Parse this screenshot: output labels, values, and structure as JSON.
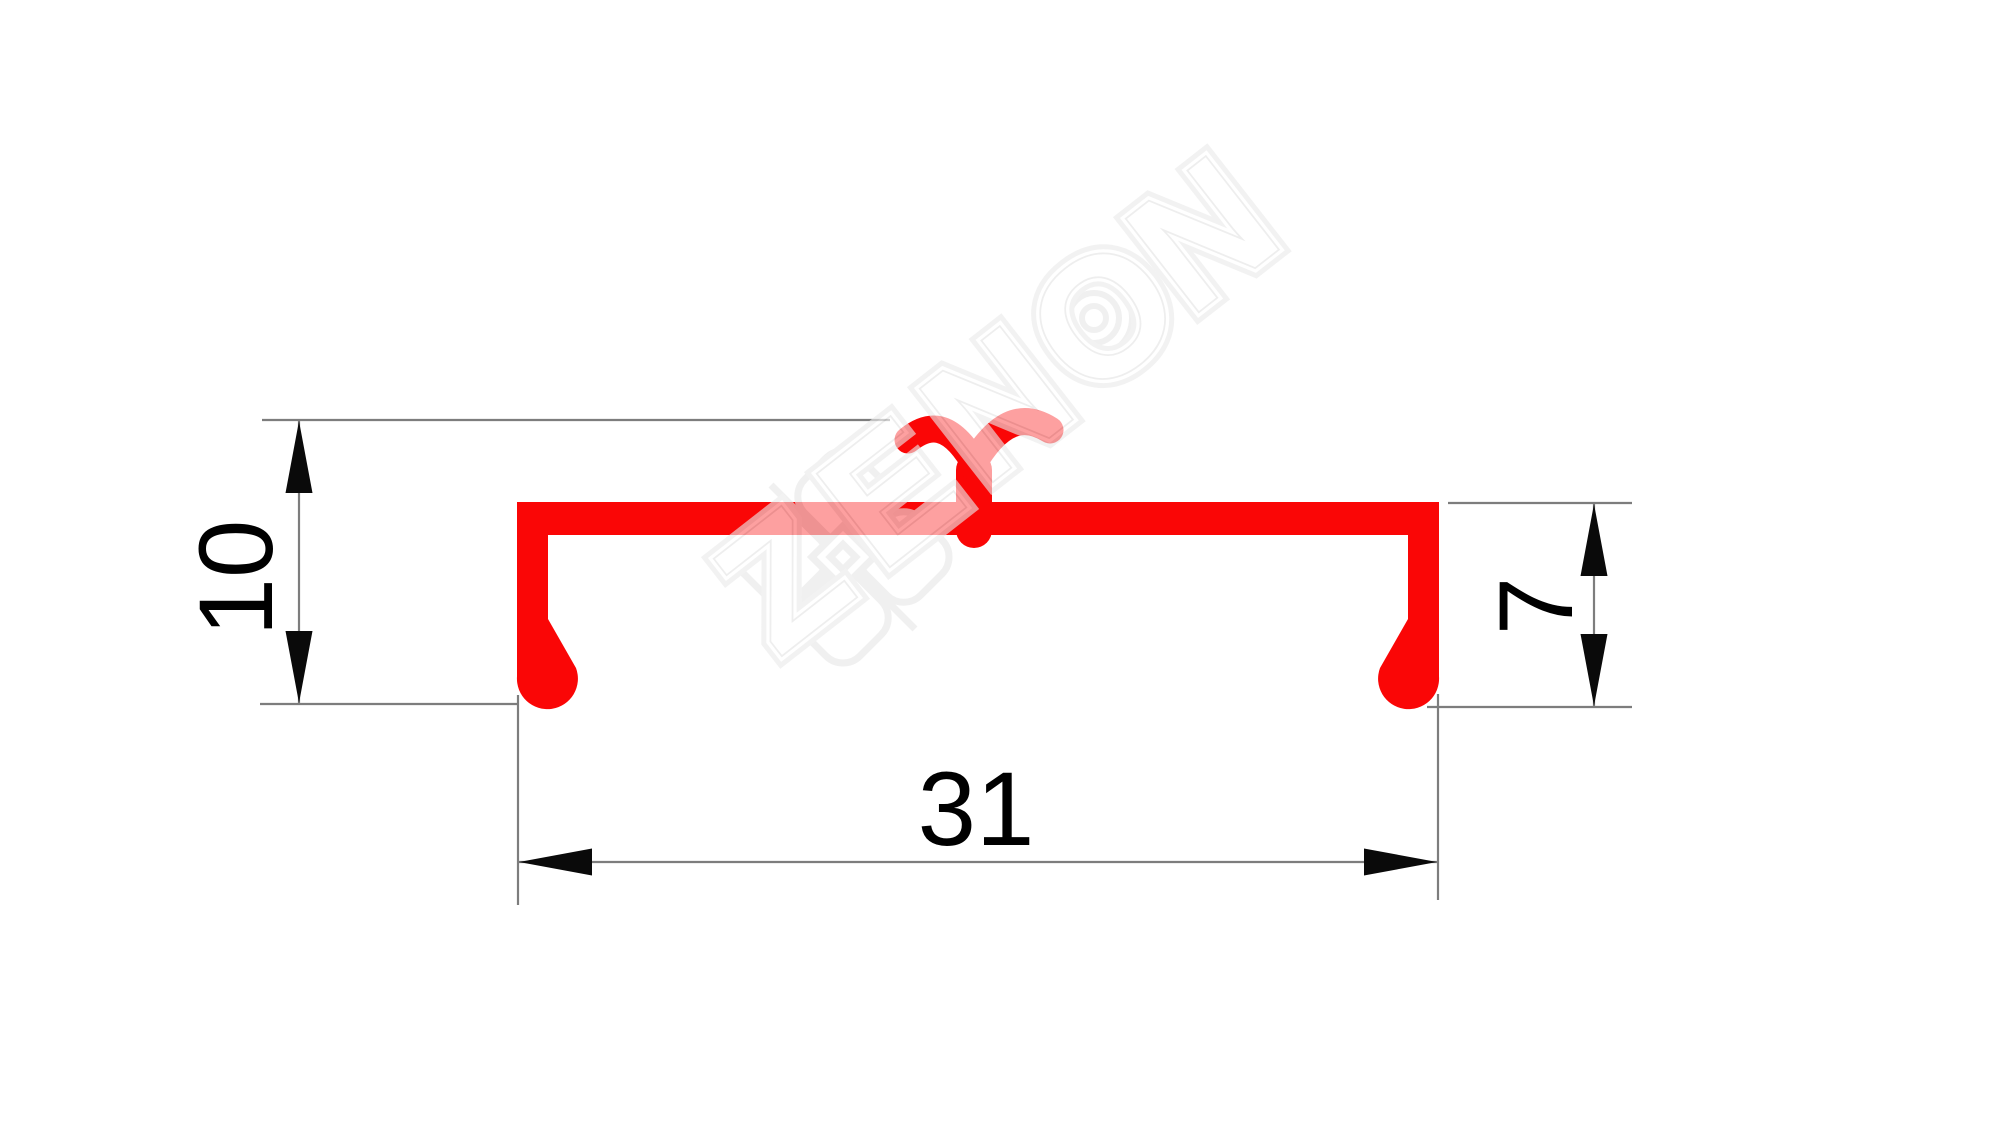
{
  "drawing": {
    "type": "aluminium-profile-cross-section",
    "colors": {
      "bg-color": "#ffffff",
      "profile-color": "#fa0606",
      "line-color": "#7d7d7d",
      "arrow-color": "#0a0a0a",
      "text-color": "#000000",
      "wm-color": "#e8e8e8"
    },
    "dimensions": [
      {
        "id": "overall-height",
        "label": "10",
        "orientation": "vertical",
        "side": "left"
      },
      {
        "id": "leg-height",
        "label": "7",
        "orientation": "vertical",
        "side": "right"
      },
      {
        "id": "overall-width",
        "label": "31",
        "orientation": "horizontal",
        "side": "bottom"
      }
    ],
    "watermark": {
      "text": "ZENON",
      "opacity": 0.62
    }
  }
}
